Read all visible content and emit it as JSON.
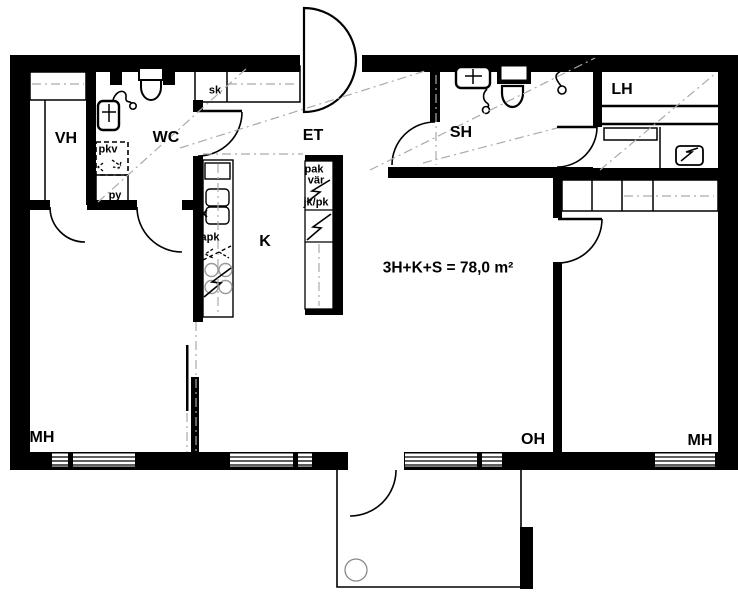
{
  "floorplan": {
    "area_text": "3H+K+S = 78,0 m²",
    "rooms": {
      "vh": "VH",
      "wc": "WC",
      "et": "ET",
      "sh": "SH",
      "lh": "LH",
      "k": "K",
      "mh_left": "MH",
      "oh": "OH",
      "mh_right": "MH"
    },
    "fixtures": {
      "sk": "sk",
      "pkv": "pkv",
      "py": "py",
      "apk": "apk",
      "pak": "pak",
      "var": "vär",
      "jkpk": "jk/pk"
    },
    "colors": {
      "wall": "#000000",
      "background": "#ffffff",
      "centerline": "#aaaaaa"
    }
  }
}
